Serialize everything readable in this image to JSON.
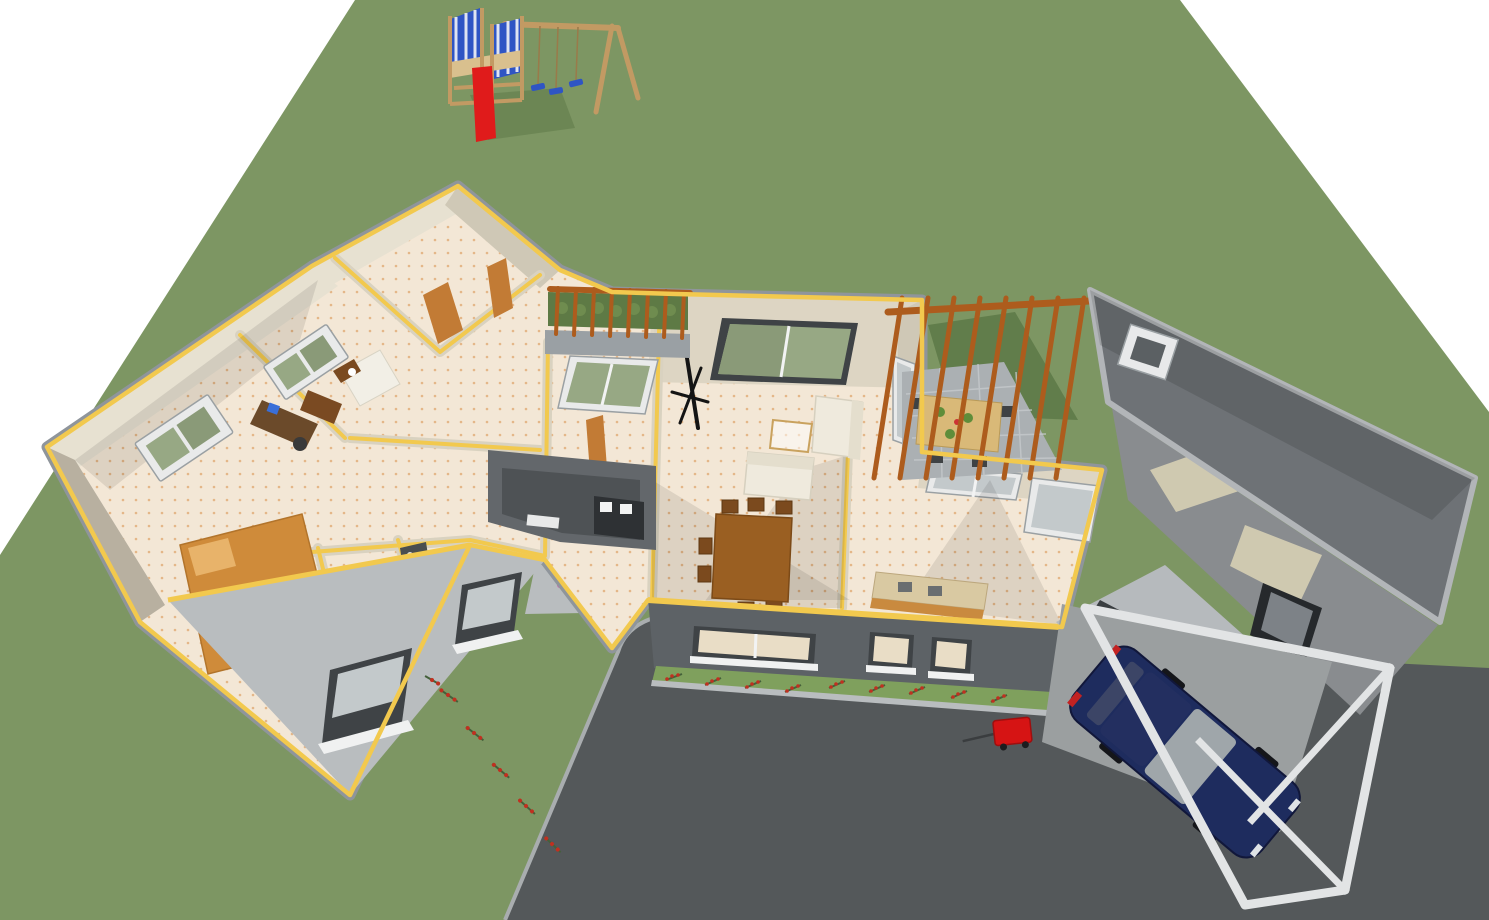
{
  "scene": {
    "view": "3D aerial cutaway rendering of a single-story house with surrounding yard",
    "objects": {
      "yard": "green lawn",
      "driveway": "dark asphalt driveway",
      "house": "cutaway house with yellow-topped walls",
      "playground": "wooden swing set with tower, blue climbing panels, three swings",
      "slide": "red slide",
      "pergola_small": "garden pergola with planting bed",
      "pergola_patio": "patio pergola with outdoor dining table",
      "living_room": "living room with white sofas, glass coffee table and wooden dining table",
      "kitchen": "kitchen with counters and corner windows",
      "bedroom_wing": "bedroom wing with beds, desk and bathroom",
      "entry_porch": "recessed entry porch with front door",
      "garage_roof": "dark gabled roof with skylight",
      "garage": "garage workshop with bench and screen",
      "carport": "white carport frame",
      "car": "dark blue car",
      "wagon": "red toy wagon",
      "flowers": "rows of red flowers"
    },
    "counts": {
      "patio_pergola_beams": 8,
      "garden_pergola_beams": 8,
      "swings": 3,
      "dining_chairs": 6,
      "facade_windows": 3
    }
  },
  "colors": {
    "background": "#ffffff",
    "grass": "#7d9663",
    "grass_shadow": "#5e7a48",
    "asphalt": "#54585a",
    "walkway": "#b9bdbf",
    "wall_cream": "#ddd5c3",
    "wall_top_yellow": "#f2c94e",
    "outer_wall_gray": "#8f959b",
    "floor": "#f3e7d6",
    "floor_dot": "#dfa267",
    "facade_dark": "#5d6266",
    "porch_dark": "#63676b",
    "porch_inner": "#4e5255",
    "roof_dark": "#6e7276",
    "roof_edge": "#b2b5b8",
    "roof_face": "#b6babd",
    "window_glass_green": "#97a884",
    "pergola_wood": "#ad5c1d",
    "patio_stone": "#abb0b3",
    "table_wood": "#9a5f22",
    "outdoor_table": "#d9b978",
    "sofa_white": "#efeadd",
    "bed_orange": "#cf8b3a",
    "door_orange": "#c27b35",
    "car_navy": "#1e2c5e",
    "car_glass": "#9fa6aa",
    "carport_white": "#e2e4e5",
    "slide_red": "#e01b1b",
    "wagon_red": "#d61414",
    "playground_wood": "#c29a63",
    "playground_blue": "#2f55c4",
    "flower_red": "#c03020",
    "lawn_strip": "#7fa05d"
  }
}
